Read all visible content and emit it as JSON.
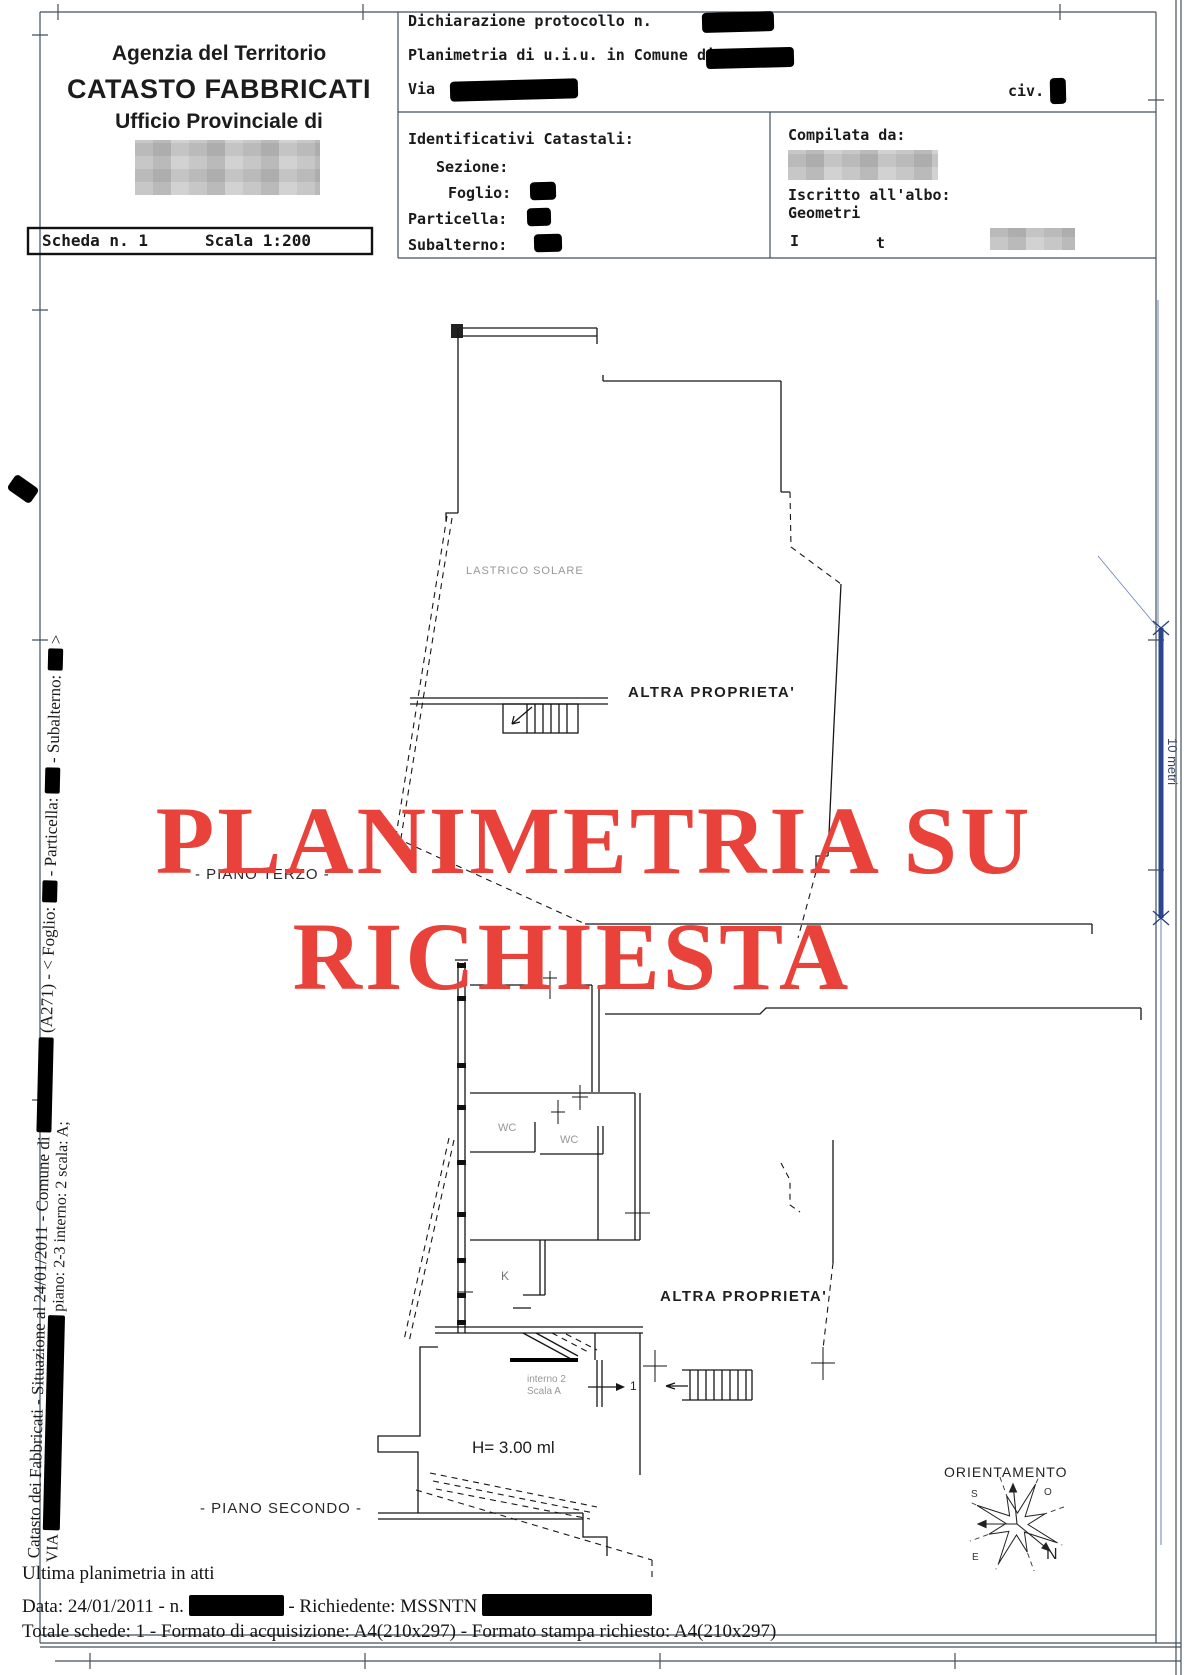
{
  "header": {
    "agency_line1": "Agenzia del Territorio",
    "agency_line2": "CATASTO FABBRICATI",
    "agency_line3": "Ufficio Provinciale di",
    "declaration_label": "Dichiarazione protocollo n.",
    "planimetria_label": "Planimetria di u.i.u. in Comune di",
    "via_label": "Via",
    "civ_label": "civ.",
    "identificativi_title": "Identificativi Catastali:",
    "sezione_label": "Sezione:",
    "foglio_label": "Foglio:",
    "particella_label": "Particella:",
    "subalterno_label": "Subalterno:",
    "compilata_label": "Compilata da:",
    "iscritto_label": "Iscritto all'albo:",
    "iscritto_value": "Geometri",
    "partial_left": "I",
    "partial_right": "t"
  },
  "scheda": {
    "label": "Scheda n. 1",
    "scale": "Scala 1:200"
  },
  "plan": {
    "lastrico": "LASTRICO SOLARE",
    "altra_proprieta_1": "ALTRA PROPRIETA'",
    "piano_terzo": "- PIANO TERZO -",
    "watermark_line1": "PLANIMETRIA SU",
    "watermark_line2": "RICHIESTA",
    "watermark_color": "#e8423a",
    "wc_1": "WC",
    "wc_2": "WC",
    "kitchen": "K",
    "altra_proprieta_2": "ALTRA PROPRIETA'",
    "interno": "interno 2",
    "scala": "Scala A",
    "stair_exit_number": "1",
    "height_label": "H= 3.00 ml",
    "piano_secondo": "- PIANO SECONDO -",
    "orientamento": "ORIENTAMENTO",
    "compass": {
      "n": "N",
      "s": "S",
      "e": "E",
      "o": "O"
    },
    "scale_bar_label": "10 metri",
    "scale_bar_color": "#2b4590"
  },
  "side": {
    "line1_a": "Catasto dei Fabbricati - Situazione al 24/01/2011 - Comune di ",
    "line1_b": " (A271) - < Foglio: ",
    "line1_c": " - Particella: ",
    "line1_d": " - Subalterno: ",
    "line1_e": " >",
    "line2_a": "VIA ",
    "line2_b": " piano: 2-3 interno: 2 scala: A;"
  },
  "footer": {
    "line1": "Ultima planimetria in atti",
    "line2_a": "Data: 24/01/2011 - n. ",
    "line2_b": " - Richiedente: MSSNTN ",
    "line3": "Totale schede: 1 - Formato di acquisizione: A4(210x297)  - Formato stampa richiesto: A4(210x297)"
  }
}
